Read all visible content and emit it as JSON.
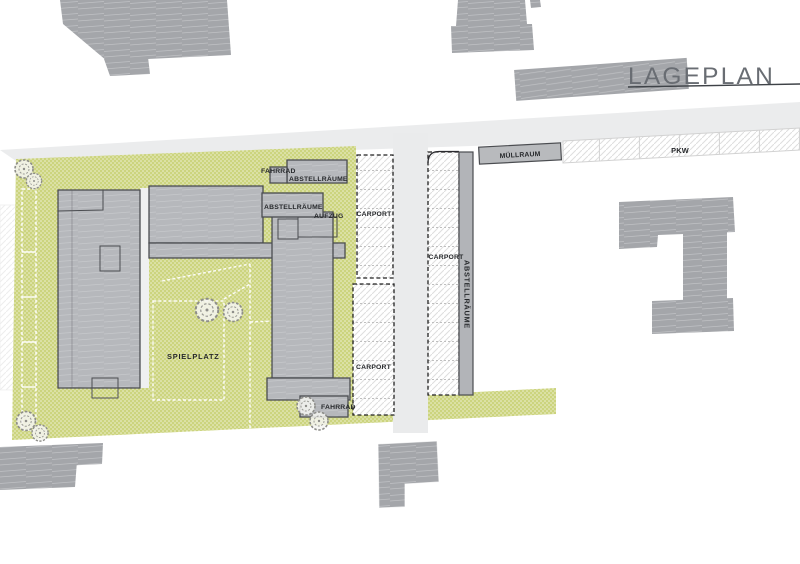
{
  "title": {
    "text": "LAGEPLAN"
  },
  "plan": {
    "labels": {
      "bike_north": "FAHRRAD",
      "storage_north": "ABSTELLRÄUME",
      "storage_mid": "ABSTELLRÄUME",
      "elevator": "AUFZUG",
      "carport_north": "CARPORT",
      "carport_south": "CARPORT",
      "carport_east": "CARPORT",
      "storage_east": "ABSTELLRÄUME",
      "waste_room": "MÜLLRAUM",
      "parking": "PKW",
      "playground": "SPIELPLATZ",
      "bike_south": "FAHRRAD"
    },
    "colors": {
      "site_green": "#ccd47e",
      "building_main": "#b6b8bc",
      "building_outline": "#4b4d51",
      "building_existing": "#a4a6aa",
      "street": "#ebeced",
      "hatch_line": "#dedede",
      "title_text": "#696d73",
      "title_rule": "#3e4247",
      "label_text": "#26282b"
    }
  }
}
